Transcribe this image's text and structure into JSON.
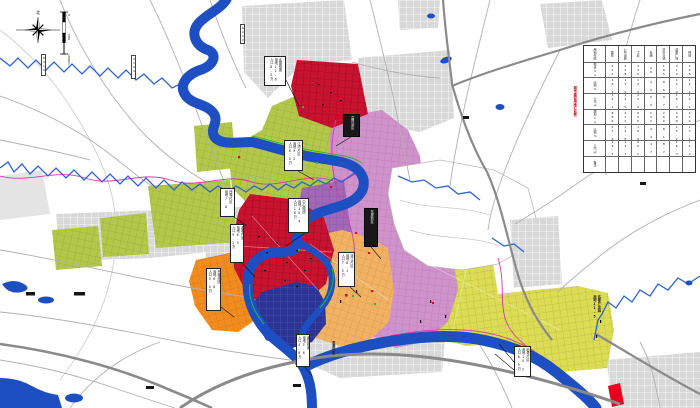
{
  "compass": {
    "north_label": "北"
  },
  "scale_bar": {
    "ticks": [
      "0",
      "500",
      "1000m"
    ]
  },
  "legend_table": {
    "title": "城市建设用地汇总表",
    "cells": [
      "用地代码",
      "居住",
      "公共设施",
      "工业",
      "仓储",
      "对外交通",
      "道路广场",
      "绿地",
      "现状ha",
      "612",
      "238",
      "420",
      "96",
      "185",
      "310",
      "268",
      "比例%",
      "28.4",
      "11.0",
      "19.5",
      "4.5",
      "8.6",
      "14.4",
      "12.4",
      "人均㎡",
      "32.1",
      "12.5",
      "22.0",
      "5.0",
      "9.7",
      "16.3",
      "14.1",
      "规划ha",
      "886",
      "412",
      "605",
      "142",
      "260",
      "488",
      "420",
      "比例%",
      "27.6",
      "12.8",
      "18.8",
      "4.4",
      "8.1",
      "15.2",
      "13.1",
      "人均㎡",
      "29.5",
      "13.7",
      "20.2",
      "4.7",
      "8.7",
      "16.3",
      "14.0",
      "备注",
      "",
      "",
      "",
      "",
      "",
      "",
      ""
    ]
  },
  "callouts": [
    {
      "lines": [
        "北部组团",
        "用地12.6",
        "人口8.5万"
      ]
    },
    {
      "lines": [
        "高铁站区",
        "",
        ""
      ]
    },
    {
      "lines": [
        "江湾片区",
        "用地9.2",
        "人口6.0万"
      ]
    },
    {
      "lines": [
        "西城片区",
        "用地7.8",
        ""
      ]
    },
    {
      "lines": [
        "中心组团",
        "用地15.4",
        "人口18万"
      ]
    },
    {
      "lines": [
        "老城片区",
        "用地6.3",
        "人口9.2万"
      ]
    },
    {
      "lines": [
        "东岸新区",
        "",
        ""
      ]
    },
    {
      "lines": [
        "滨江片区",
        "用地8.1",
        "人口7.5万"
      ]
    },
    {
      "lines": [
        "南部组团",
        "用地5.6",
        "人口4.8万"
      ]
    },
    {
      "lines": [
        "临港片区",
        "用地10.2",
        "人口6.5万"
      ]
    },
    {
      "lines": [
        "西南组团",
        "用地6.8",
        "人口5.0万"
      ]
    },
    {
      "lines": [
        "东部产业园",
        "用地11.5",
        ""
      ]
    },
    {
      "lines": [
        "李渡片区",
        "",
        ""
      ]
    }
  ],
  "road_labels": [
    "G319",
    "X103",
    "G212"
  ],
  "colors": {
    "river": "#1e4fc2",
    "red_district": "#c8122f",
    "orange_district": "#f28c1e",
    "tan_district": "#f2b263",
    "lime_district": "#b3c84b",
    "yellow_district": "#dcdc55",
    "pink_district": "#d092cb",
    "purple_district": "#a168b8",
    "dark_blue_district": "#2b3494",
    "gray_district": "#d8d8d8",
    "boundary_line": "#d13ab0",
    "table_title": "#cc0000"
  }
}
